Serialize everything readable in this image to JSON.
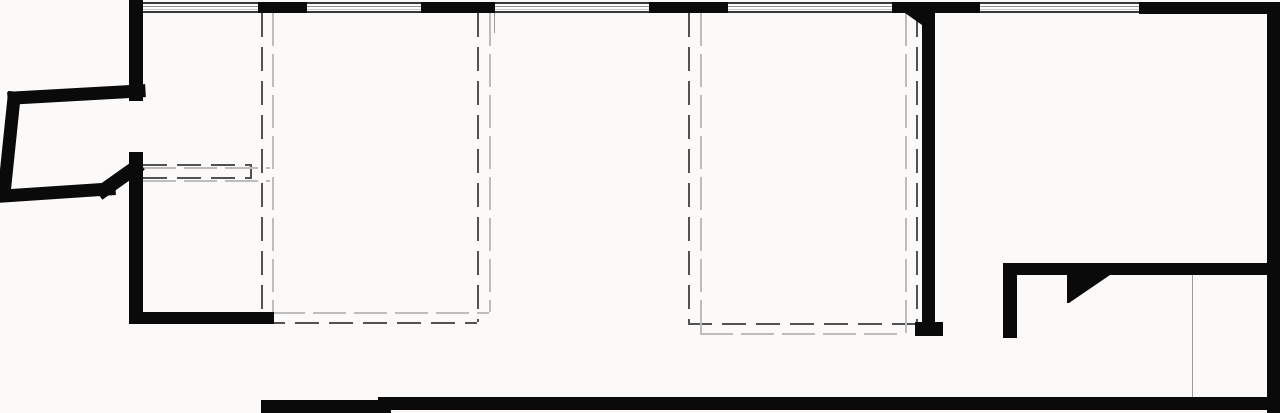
{
  "canvas": {
    "width": 1280,
    "height": 413,
    "background": "#fbfaf9"
  },
  "colors": {
    "wall": "#0a0a0a",
    "dash_dark": "#525252",
    "dash_light": "#bdbdbd",
    "thin_line": "#9a9a9a",
    "window_frame": "#383838",
    "window_mid": "#909090",
    "window_light": "#c8c8c8",
    "glass": "#fdfcfc"
  },
  "walls": [
    {
      "name": "wall-left-upper",
      "x": 129,
      "y": 0,
      "w": 14,
      "h": 101
    },
    {
      "name": "wall-top-segment-1",
      "x": 258,
      "y": 2,
      "w": 49,
      "h": 11
    },
    {
      "name": "wall-top-segment-2",
      "x": 421,
      "y": 2,
      "w": 74,
      "h": 11
    },
    {
      "name": "wall-top-segment-3",
      "x": 649,
      "y": 2,
      "w": 79,
      "h": 11
    },
    {
      "name": "wall-top-segment-4",
      "x": 892,
      "y": 2,
      "w": 88,
      "h": 11
    },
    {
      "name": "wall-top-segment-5",
      "x": 1139,
      "y": 2,
      "w": 141,
      "h": 12
    },
    {
      "name": "wall-left-lower",
      "x": 129,
      "y": 152,
      "w": 14,
      "h": 172
    },
    {
      "name": "wall-room1-bottom",
      "x": 129,
      "y": 312,
      "w": 145,
      "h": 12
    },
    {
      "name": "wall-interior-vertical",
      "x": 922,
      "y": 13,
      "w": 13,
      "h": 310
    },
    {
      "name": "wall-interior-footing",
      "x": 915,
      "y": 322,
      "w": 28,
      "h": 14
    },
    {
      "name": "wall-right",
      "x": 1267,
      "y": 13,
      "w": 13,
      "h": 400
    },
    {
      "name": "wall-right-horizontal",
      "x": 1003,
      "y": 263,
      "w": 277,
      "h": 12
    },
    {
      "name": "wall-closet-vertical",
      "x": 1003,
      "y": 263,
      "w": 14,
      "h": 75
    },
    {
      "name": "wall-bottom-left",
      "x": 261,
      "y": 400,
      "w": 130,
      "h": 13
    },
    {
      "name": "wall-bottom-main",
      "x": 378,
      "y": 397,
      "w": 902,
      "h": 13
    }
  ],
  "slanted_walls": [
    {
      "name": "wall-bay-top",
      "x1": 14,
      "y1": 98,
      "x2": 139,
      "y2": 91,
      "w": 13
    },
    {
      "name": "wall-bay-left",
      "x1": 14,
      "y1": 98,
      "x2": 4,
      "y2": 194,
      "w": 13
    },
    {
      "name": "wall-bay-bottom",
      "x1": 4,
      "y1": 196,
      "x2": 109,
      "y2": 189,
      "w": 13
    },
    {
      "name": "wall-bay-diagonal",
      "x1": 104,
      "y1": 190,
      "x2": 135,
      "y2": 168,
      "w": 14
    }
  ],
  "polygons": [
    {
      "name": "wall-tee-bevel",
      "points": "905,13 922,13 922,25"
    },
    {
      "name": "wall-angled-return",
      "points": "1067,275 1110,275 1069,303 1067,303"
    }
  ],
  "windows": [
    {
      "name": "window-1",
      "x": 143,
      "w": 115
    },
    {
      "name": "window-2",
      "x": 307,
      "w": 114
    },
    {
      "name": "window-3",
      "x": 495,
      "w": 154
    },
    {
      "name": "window-4",
      "x": 728,
      "w": 164
    },
    {
      "name": "window-5",
      "x": 980,
      "w": 159
    }
  ],
  "dashed_rects": [
    {
      "name": "void-outline-1-dark",
      "x": 261,
      "y": 13,
      "w": 216,
      "h": 309,
      "tone": "dark"
    },
    {
      "name": "void-outline-1-light",
      "x": 272,
      "y": 13,
      "w": 217,
      "h": 299,
      "tone": "light"
    },
    {
      "name": "void-outline-2-dark",
      "x": 688,
      "y": 13,
      "w": 228,
      "h": 310,
      "tone": "dark"
    },
    {
      "name": "void-outline-2-light",
      "x": 700,
      "y": 13,
      "w": 205,
      "h": 320,
      "tone": "light"
    }
  ],
  "dashed_lines": [
    {
      "name": "beam-line-top-dark",
      "x1": 143,
      "y1": 164,
      "x2": 250,
      "y2": 164,
      "tone": "dark"
    },
    {
      "name": "beam-line-bottom-dark",
      "x1": 143,
      "y1": 177,
      "x2": 250,
      "y2": 177,
      "tone": "dark"
    },
    {
      "name": "beam-line-end-dark",
      "x1": 250,
      "y1": 164,
      "x2": 250,
      "y2": 179,
      "tone": "dark"
    },
    {
      "name": "beam-line-top-light",
      "x1": 143,
      "y1": 167,
      "x2": 270,
      "y2": 167,
      "tone": "light"
    },
    {
      "name": "beam-line-bottom-light",
      "x1": 143,
      "y1": 180,
      "x2": 270,
      "y2": 180,
      "tone": "light"
    }
  ],
  "thin_lines": [
    {
      "name": "partition-reference-line",
      "x": 1192,
      "y": 275,
      "w": 1,
      "h": 122
    },
    {
      "name": "reveal-reference-line",
      "x": 494,
      "y": 13,
      "w": 1,
      "h": 20
    }
  ]
}
